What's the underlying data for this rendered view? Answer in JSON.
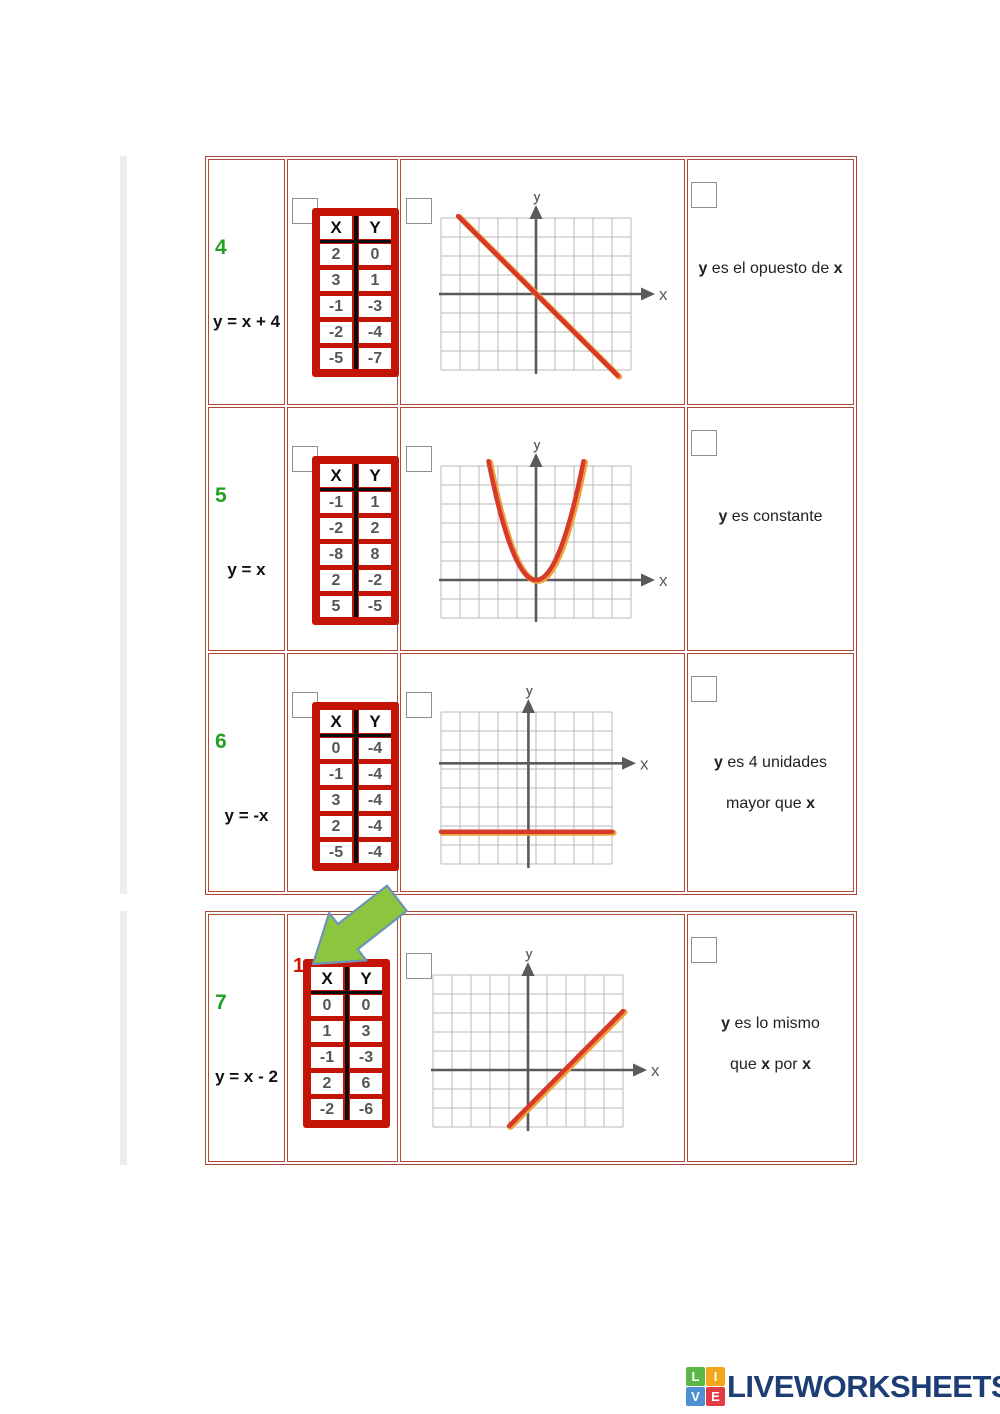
{
  "page": {
    "background": "#ffffff"
  },
  "colors": {
    "table_border": "#a8493b",
    "cell_border": "#b0493a",
    "xy_frame": "#c41405",
    "number_green": "#22a022",
    "answer_red": "#cc1606",
    "curve_red": "#d63a2a",
    "curve_orange": "#efa23c",
    "axis_gray": "#5a5a5a",
    "grid_gray": "#b8b8b8",
    "arrow_green": "#8cc63e",
    "arrow_outline": "#6e93b8",
    "logo_navy": "#1c3e75",
    "checkbox_border": "#8f8f8f"
  },
  "rows": [
    {
      "num": "4",
      "equation": "y = x + 4",
      "xy": {
        "headers": [
          "X",
          "Y"
        ],
        "values": [
          [
            "2",
            "0"
          ],
          [
            "3",
            "1"
          ],
          [
            "-1",
            "-3"
          ],
          [
            "-2",
            "-4"
          ],
          [
            "-5",
            "-7"
          ]
        ]
      },
      "desc": [
        [
          {
            "t": "y",
            "b": true
          },
          {
            "t": " es el opuesto de "
          },
          {
            "t": "x",
            "b": true
          }
        ]
      ],
      "graph": {
        "cols": 10,
        "rows": 8,
        "origin": [
          5,
          4
        ],
        "xlabel": "x",
        "ylabel": "y",
        "curve": {
          "type": "line",
          "from": [
            0.9,
            -0.1
          ],
          "to": [
            9.3,
            8.3
          ]
        }
      }
    },
    {
      "num": "5",
      "equation": "y = x",
      "xy": {
        "headers": [
          "X",
          "Y"
        ],
        "values": [
          [
            "-1",
            "1"
          ],
          [
            "-2",
            "2"
          ],
          [
            "-8",
            "8"
          ],
          [
            "2",
            "-2"
          ],
          [
            "5",
            "-5"
          ]
        ]
      },
      "desc": [
        [
          {
            "t": "y",
            "b": true
          },
          {
            "t": " es constante"
          }
        ]
      ],
      "graph": {
        "cols": 10,
        "rows": 8,
        "origin": [
          5,
          6
        ],
        "xlabel": "x",
        "ylabel": "y",
        "curve": {
          "type": "parabola",
          "a": 1.0,
          "tmax": 2.5
        }
      }
    },
    {
      "num": "6",
      "equation": "y = -x",
      "xy": {
        "headers": [
          "X",
          "Y"
        ],
        "values": [
          [
            "0",
            "-4"
          ],
          [
            "-1",
            "-4"
          ],
          [
            "3",
            "-4"
          ],
          [
            "2",
            "-4"
          ],
          [
            "-5",
            "-4"
          ]
        ]
      },
      "desc": [
        [
          {
            "t": "y",
            "b": true
          },
          {
            "t": " es 4 unidades"
          }
        ],
        [
          {
            "t": "mayor que "
          },
          {
            "t": "x",
            "b": true
          }
        ]
      ],
      "graph": {
        "cols": 9,
        "rows": 8,
        "origin": [
          4.6,
          2.7
        ],
        "xlabel": "x",
        "ylabel": "y",
        "curve": {
          "type": "hline",
          "row": 6.3
        }
      }
    },
    {
      "num": "7",
      "equation": "y = x - 2",
      "xy": {
        "headers": [
          "X",
          "Y"
        ],
        "values": [
          [
            "0",
            "0"
          ],
          [
            "1",
            "3"
          ],
          [
            "-1",
            "-3"
          ],
          [
            "2",
            "6"
          ],
          [
            "-2",
            "-6"
          ]
        ]
      },
      "desc": [
        [
          {
            "t": "y",
            "b": true
          },
          {
            "t": " es lo mismo"
          }
        ],
        [
          {
            "t": "que "
          },
          {
            "t": "x",
            "b": true
          },
          {
            "t": " por "
          },
          {
            "t": "x",
            "b": true
          }
        ]
      ],
      "graph": {
        "cols": 10,
        "rows": 8,
        "origin": [
          5,
          5
        ],
        "xlabel": "x",
        "ylabel": "y",
        "curve": {
          "type": "line",
          "from": [
            4.0,
            7.95
          ],
          "to": [
            10,
            1.9
          ]
        }
      },
      "answer_marker": "1"
    }
  ],
  "logo": {
    "text": "LIVEWORKSHEETS",
    "tiles": [
      {
        "ch": "L",
        "color": "#5bb847"
      },
      {
        "ch": "I",
        "color": "#f2a71b"
      },
      {
        "ch": "V",
        "color": "#4f8fd3"
      },
      {
        "ch": "E",
        "color": "#e23b44"
      }
    ]
  }
}
